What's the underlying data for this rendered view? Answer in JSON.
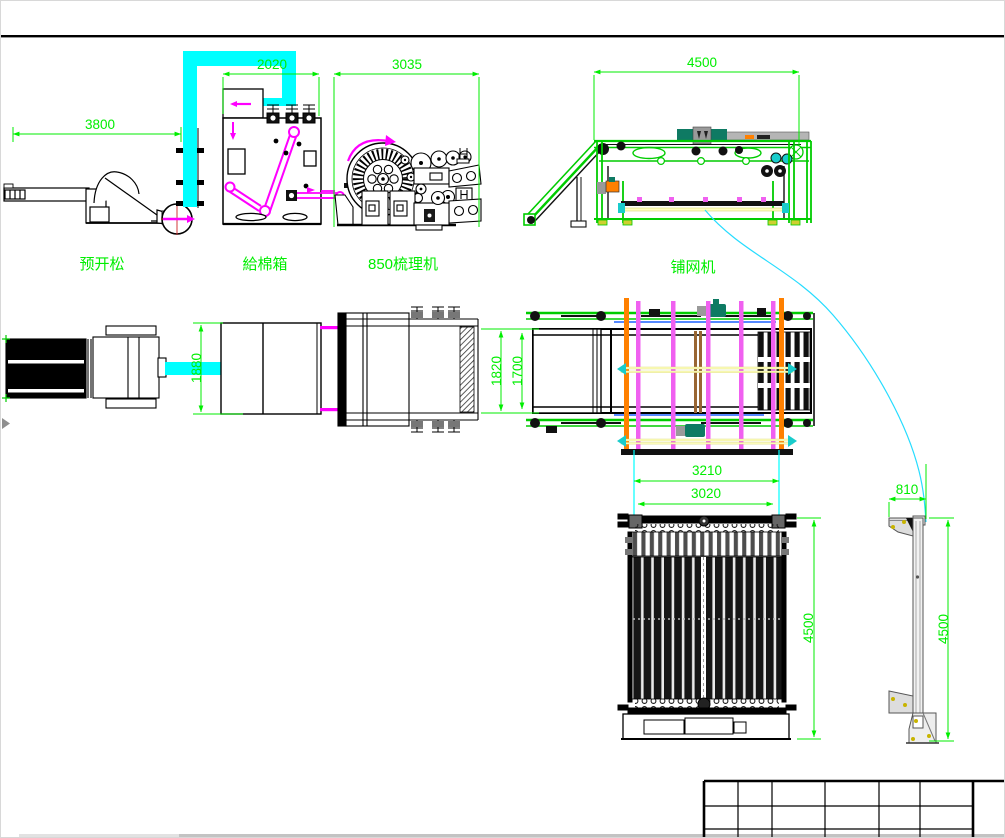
{
  "drawing": {
    "title": "nonwoven production line layout",
    "machines": [
      {
        "id": "pre-opener",
        "label": "预开松"
      },
      {
        "id": "feed-box",
        "label": "給棉箱"
      },
      {
        "id": "carding-machine",
        "label": "850梳理机"
      },
      {
        "id": "lapper",
        "label": "铺网机"
      }
    ],
    "dimensions": {
      "pre_opener_length": "3800",
      "feed_box_width": "2020",
      "carding_length": "3035",
      "lapper_length": "4500",
      "pre_opener_plan_width": "1880",
      "carding_plan_width": "1820",
      "lapper_infeed_width": "1700",
      "lapper_plan_span_outer": "3210",
      "lapper_plan_span_inner": "3020",
      "lapper_front_height": "4500",
      "lapper_profile_depth": "810",
      "lapper_profile_height": "4500"
    },
    "colors": {
      "dimension_green": "#00ee00",
      "duct_cyan": "#00ffff",
      "conveyor_magenta": "#ff00ff",
      "plan_bar_pink": "#f060f0",
      "accent_orange": "#ff8000",
      "guide_blue": "#5588ff",
      "belt_yellow": "#ffffbf",
      "teal_motor": "#0e7a63",
      "brown_bar": "#996633"
    }
  }
}
